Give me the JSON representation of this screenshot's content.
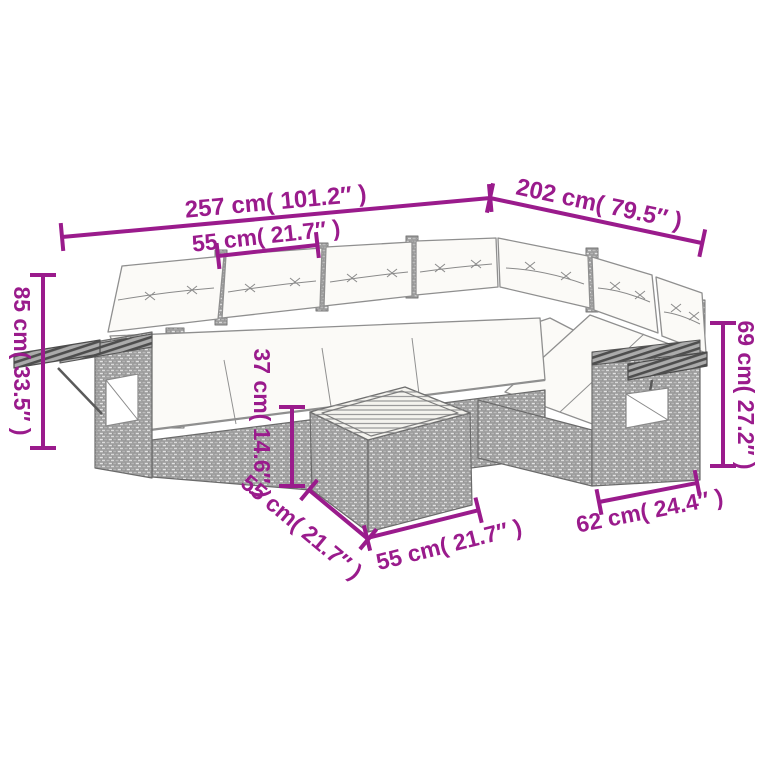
{
  "colors": {
    "accent": "#9a1b8c",
    "background": "#ffffff",
    "wicker_gray": "#c9c9c9",
    "cushion_white": "#fbfaf7"
  },
  "dimensions": {
    "total_width": {
      "text": "257 cm( 101.2″ )",
      "cm": 257,
      "inches": 101.2
    },
    "right_depth": {
      "text": "202 cm( 79.5″ )",
      "cm": 202,
      "inches": 79.5
    },
    "seat_width": {
      "text": "55 cm( 21.7″ )",
      "cm": 55,
      "inches": 21.7
    },
    "back_height": {
      "text": "85 cm( 33.5″ )",
      "cm": 85,
      "inches": 33.5
    },
    "arm_height": {
      "text": "69 cm( 27.2″ )",
      "cm": 69,
      "inches": 27.2
    },
    "table_height": {
      "text": "37 cm( 14.6″ )",
      "cm": 37,
      "inches": 14.6
    },
    "table_depth": {
      "text": "55 cm( 21.7″ )",
      "cm": 55,
      "inches": 21.7
    },
    "table_width": {
      "text": "55 cm( 21.7″ )",
      "cm": 55,
      "inches": 21.7
    },
    "armrest_depth": {
      "text": "62 cm( 24.4″ )",
      "cm": 62,
      "inches": 24.4
    }
  }
}
